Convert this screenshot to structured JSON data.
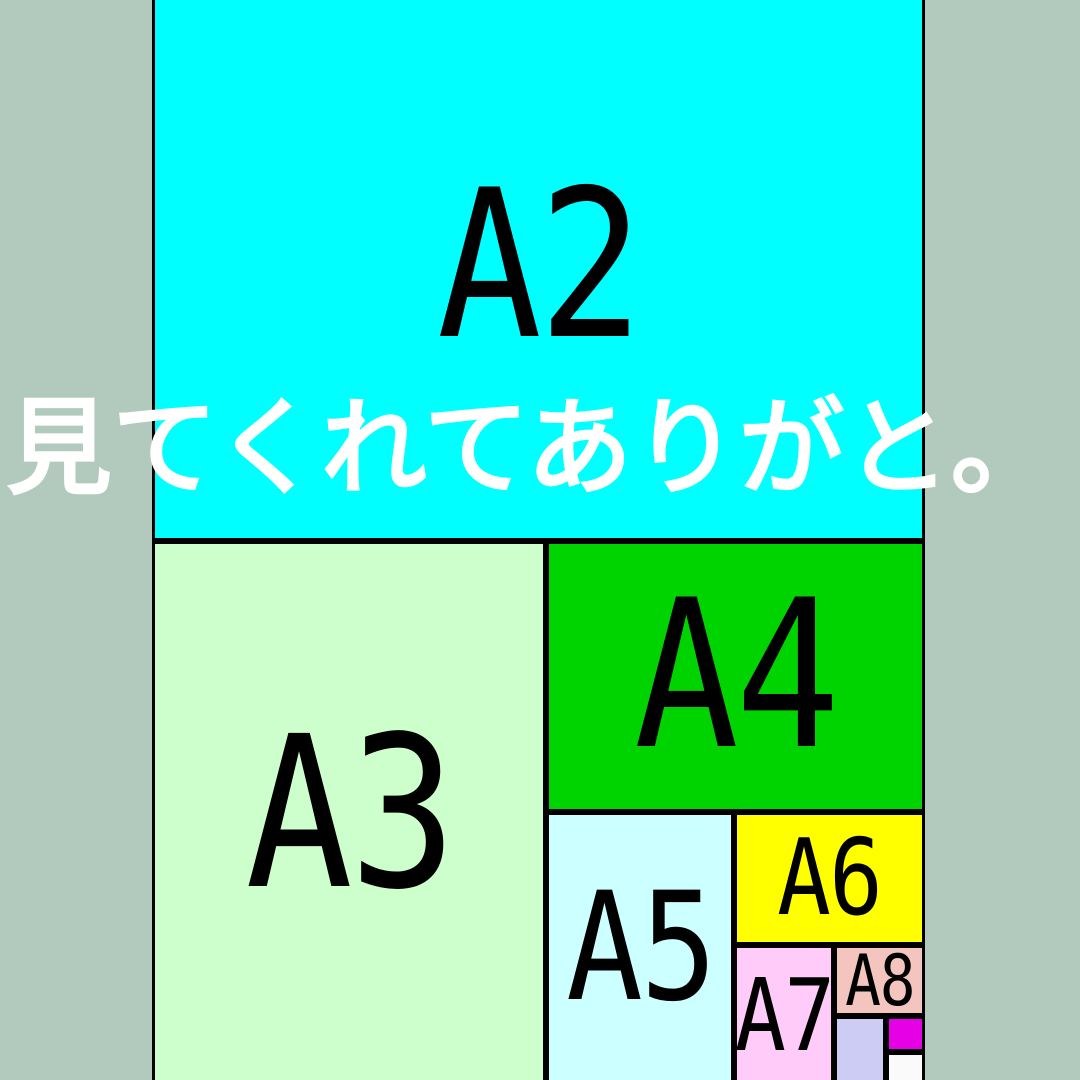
{
  "colors": {
    "background": "#b2c9bd",
    "border": "#000000",
    "label_text": "#000000",
    "caption_text": "#ffffff"
  },
  "overlay_text": {
    "text": "見てくれてありがと。",
    "color": "#ffffff"
  },
  "diagram": {
    "title": "paper-size-nesting-diagram",
    "sheets": [
      {
        "label": "A2",
        "color": "#00ffff",
        "x": 152,
        "y": -8,
        "w": 773,
        "h": 549,
        "font_px": 205
      },
      {
        "label": "A3",
        "color": "#ccffcc",
        "x": 152,
        "y": 541,
        "w": 394,
        "h": 546,
        "font_px": 210
      },
      {
        "label": "A4",
        "color": "#00d400",
        "x": 546,
        "y": 541,
        "w": 379,
        "h": 271,
        "font_px": 205
      },
      {
        "label": "A5",
        "color": "#ccffff",
        "x": 546,
        "y": 812,
        "w": 188,
        "h": 271,
        "font_px": 150
      },
      {
        "label": "A6",
        "color": "#ffff00",
        "x": 734,
        "y": 812,
        "w": 191,
        "h": 133,
        "font_px": 105
      },
      {
        "label": "A7",
        "color": "#ffccf9",
        "x": 734,
        "y": 945,
        "w": 100,
        "h": 141,
        "font_px": 100
      },
      {
        "label": "A8",
        "color": "#f3c5be",
        "x": 834,
        "y": 945,
        "w": 91,
        "h": 71,
        "font_px": 70
      },
      {
        "label": "",
        "color": "#ccccf5",
        "x": 834,
        "y": 1016,
        "w": 52,
        "h": 71,
        "font_px": 0
      },
      {
        "label": "",
        "color": "#e500e5",
        "x": 886,
        "y": 1016,
        "w": 39,
        "h": 36,
        "font_px": 0
      },
      {
        "label": "",
        "color": "#fafafa",
        "x": 886,
        "y": 1052,
        "w": 39,
        "h": 36,
        "font_px": 0
      }
    ]
  }
}
